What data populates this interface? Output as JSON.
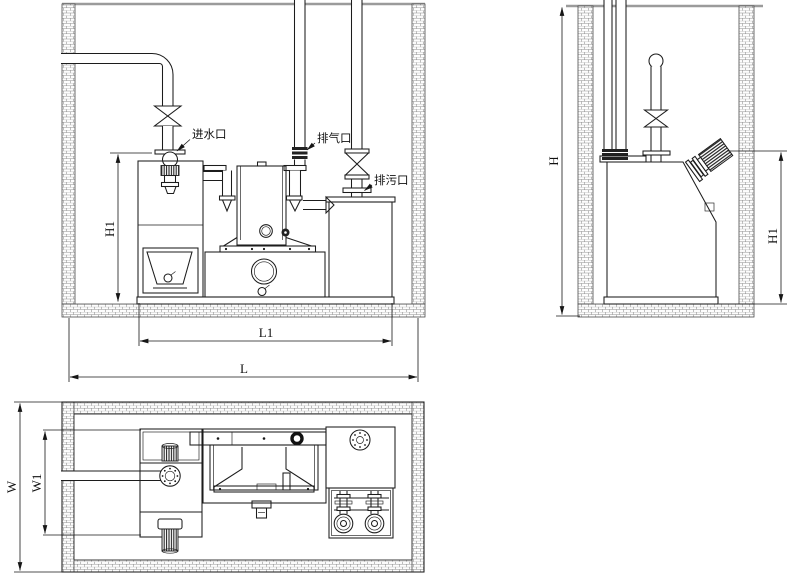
{
  "drawing": {
    "type": "installation-drawing",
    "views": [
      "front-section",
      "side-section",
      "plan"
    ],
    "colors": {
      "line": "#1c1c1c",
      "dimension": "#161616",
      "ground_line": "#9b9b9b",
      "brick_joint": "#8a8a8a",
      "background": "#ffffff"
    }
  },
  "labels": {
    "inlet": "进水口",
    "air_outlet": "排气口",
    "drain_outlet": "排污口"
  },
  "dims": {
    "front": {
      "h1": "H1",
      "l1": "L1",
      "l": "L"
    },
    "side": {
      "h": "H",
      "h1": "H1"
    },
    "plan": {
      "w": "W",
      "w1": "W1"
    }
  }
}
